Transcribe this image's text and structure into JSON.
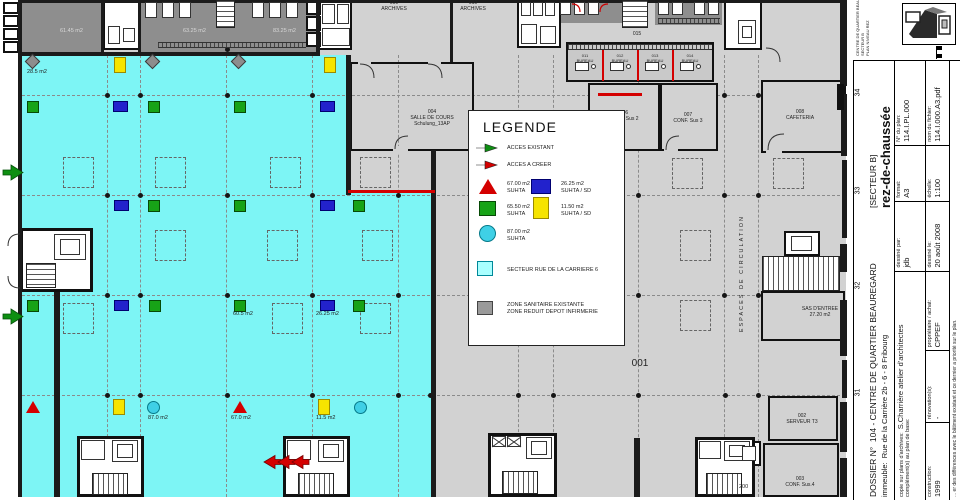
{
  "colors": {
    "sector_cyan": "#7df5f5",
    "floor_gray": "#d2d2d2",
    "dark_zone": "#8e8e8e",
    "green": "#17a317",
    "blue": "#2222cc",
    "yellow": "#f6e400",
    "red": "#d40000",
    "circle_cyan": "#3fd0e6",
    "legend_cyan": "#a9ffff",
    "wall": "#1b1b1b"
  },
  "legend": {
    "title": "LEGENDE",
    "items": [
      {
        "icon": "arrow-green",
        "lines": [
          "ACCES EXISTANT"
        ]
      },
      {
        "icon": "arrow-red",
        "lines": [
          "ACCES A CREER"
        ]
      },
      {
        "icon": "triangle-red",
        "lines": [
          "67.00 m2",
          "SUHTA"
        ]
      },
      {
        "icon": "square-blue",
        "lines": [
          "26.25 m2",
          "SUHTA / SD"
        ]
      },
      {
        "icon": "square-green",
        "lines": [
          "65.50 m2",
          "SUHTA"
        ]
      },
      {
        "icon": "square-yellow",
        "lines": [
          "11.50 m2",
          "SUHTA / SD"
        ]
      },
      {
        "icon": "circle-cyan",
        "lines": [
          "87.00 m2",
          "SUHTA"
        ]
      },
      {
        "icon": "square-cyan",
        "lines": [
          "SECTEUR RUE DE LA CARRIERE 6"
        ]
      },
      {
        "icon": "square-gray",
        "lines": [
          "ZONE SANITAIRE EXISTANTE",
          "ZONE REDUIT DEPOT INFIRMERIE"
        ]
      }
    ]
  },
  "plan": {
    "markers": [
      {
        "t": "diamond",
        "x": 27,
        "y": 56
      },
      {
        "t": "diamond",
        "x": 147,
        "y": 56
      },
      {
        "t": "diamond",
        "x": 233,
        "y": 56
      },
      {
        "t": "yellow",
        "x": 114,
        "y": 57
      },
      {
        "t": "yellow",
        "x": 324,
        "y": 57
      },
      {
        "t": "green",
        "x": 27,
        "y": 101
      },
      {
        "t": "blue",
        "x": 113,
        "y": 101
      },
      {
        "t": "green",
        "x": 148,
        "y": 101
      },
      {
        "t": "green",
        "x": 234,
        "y": 101
      },
      {
        "t": "blue",
        "x": 320,
        "y": 101
      },
      {
        "t": "blue",
        "x": 114,
        "y": 200
      },
      {
        "t": "green",
        "x": 148,
        "y": 200
      },
      {
        "t": "green",
        "x": 234,
        "y": 200
      },
      {
        "t": "blue",
        "x": 320,
        "y": 200
      },
      {
        "t": "green",
        "x": 353,
        "y": 200
      },
      {
        "t": "green",
        "x": 27,
        "y": 300
      },
      {
        "t": "blue",
        "x": 114,
        "y": 300
      },
      {
        "t": "green",
        "x": 149,
        "y": 300
      },
      {
        "t": "green",
        "x": 234,
        "y": 300
      },
      {
        "t": "blue",
        "x": 320,
        "y": 300
      },
      {
        "t": "green",
        "x": 353,
        "y": 300
      },
      {
        "t": "triangle",
        "x": 26,
        "y": 401
      },
      {
        "t": "yellow",
        "x": 113,
        "y": 399
      },
      {
        "t": "circle",
        "x": 147,
        "y": 401
      },
      {
        "t": "triangle",
        "x": 233,
        "y": 401
      },
      {
        "t": "yellow",
        "x": 318,
        "y": 399
      },
      {
        "t": "circle",
        "x": 354,
        "y": 401
      }
    ],
    "area_labels": [
      {
        "t": "28.5 m2",
        "x": 27,
        "y": 69
      },
      {
        "t": "60.5 m2",
        "x": 233,
        "y": 311
      },
      {
        "t": "26.25 m2",
        "x": 316,
        "y": 311
      },
      {
        "t": "87.0 m2",
        "x": 148,
        "y": 415
      },
      {
        "t": "67.0 m2",
        "x": 231,
        "y": 415
      },
      {
        "t": "11.5 m2",
        "x": 316,
        "y": 415
      },
      {
        "t": "61.45 m2",
        "x": 60,
        "y": 28,
        "dark": true
      },
      {
        "t": "63.25 m2",
        "x": 183,
        "y": 28,
        "dark": true
      },
      {
        "t": "83.25 m2",
        "x": 273,
        "y": 28,
        "dark": true
      },
      {
        "t": "200",
        "x": 739,
        "y": 484
      }
    ],
    "room_labels": [
      {
        "lines": [
          "009",
          "ARCHIVES"
        ],
        "x": 374,
        "y": 1,
        "w": 40,
        "fs": 5
      },
      {
        "lines": [
          "010",
          "ARCHIVES"
        ],
        "x": 453,
        "y": 1,
        "w": 40,
        "fs": 5
      },
      {
        "lines": [
          "004",
          "SALLE DE COURS",
          "Schulung_13AP"
        ],
        "x": 404,
        "y": 110,
        "w": 56,
        "fs": 5
      },
      {
        "lines": [
          "015"
        ],
        "x": 627,
        "y": 32,
        "w": 20,
        "fs": 5
      },
      {
        "lines": [
          "011",
          "BUREAU"
        ],
        "x": 569,
        "y": 54,
        "w": 32,
        "fs": 4
      },
      {
        "lines": [
          "012",
          "BUREAU"
        ],
        "x": 604,
        "y": 54,
        "w": 32,
        "fs": 4
      },
      {
        "lines": [
          "013",
          "BUREAU"
        ],
        "x": 639,
        "y": 54,
        "w": 32,
        "fs": 4
      },
      {
        "lines": [
          "014",
          "BUREAU"
        ],
        "x": 674,
        "y": 54,
        "w": 32,
        "fs": 4
      },
      {
        "lines": [
          "006",
          "CONF. Sus 2"
        ],
        "x": 602,
        "y": 111,
        "w": 44,
        "fs": 5
      },
      {
        "lines": [
          "007",
          "CONF. Sus 3"
        ],
        "x": 666,
        "y": 113,
        "w": 44,
        "fs": 5
      },
      {
        "lines": [
          "008",
          "CAFETERIA"
        ],
        "x": 778,
        "y": 110,
        "w": 44,
        "fs": 5
      },
      {
        "lines": [
          "001"
        ],
        "x": 626,
        "y": 358,
        "w": 28,
        "fs": 10
      },
      {
        "lines": [
          "SAS D'ENTREE",
          "27.20 m2"
        ],
        "x": 796,
        "y": 307,
        "w": 48,
        "fs": 5
      },
      {
        "lines": [
          "002",
          "SERVEUR T3"
        ],
        "x": 780,
        "y": 414,
        "w": 44,
        "fs": 5
      },
      {
        "lines": [
          "003",
          "CONF. Sus.4"
        ],
        "x": 778,
        "y": 477,
        "w": 44,
        "fs": 5
      },
      {
        "lines": [
          "ESPACES DE CIRCULATION"
        ],
        "x": 694,
        "y": 281,
        "w": 96,
        "fs": 5.5,
        "rot": true,
        "ls": 2
      }
    ],
    "grid_numbers": [
      {
        "n": "34",
        "y": 95
      },
      {
        "n": "33",
        "y": 193
      },
      {
        "n": "32",
        "y": 288
      },
      {
        "n": "31",
        "y": 395
      }
    ]
  },
  "title_block": {
    "dossier_label": "DOSSIER N°",
    "dossier": "104 - CENTRE DE QUARTIER BEAUREGARD",
    "secteur": "[SECTEUR B]",
    "floor": "rez-de-chaussée",
    "immeuble_label": "immeuble:",
    "immeuble": "Rue de la Carrière 2b - 6 - 8  Fribourg",
    "copie_label": "copie sur plans d'archives:",
    "copie": "S.Charrière atelier d'architectes",
    "complement_label": "complément(s) au plan de base:",
    "construction_label": "construction:",
    "construction": "1999",
    "renovation_label": "rénovation(s):",
    "renovation": "-",
    "proprietaire_label": "propriétaire / achat:",
    "proprietaire": "CPPEF",
    "dessine_par_label": "dessiné par:",
    "dessine_par": "jdb",
    "dessine_le_label": "dessiné le:",
    "dessine_le": "20 août 2008",
    "format_label": "format:",
    "format": "A3",
    "echelle_label": "échelle:",
    "echelle": "1:100",
    "plan_no_label": "N° du plan:",
    "plan_no": "114.I.PL.000",
    "fichier_label": "nom du fichier:",
    "fichier": "114.I.000.A3.pdf",
    "footnote": "... er des différences avec le bâtiment existant et ce dernier a priorité sur le plan.",
    "project_lines": [
      "CENTRE DE QUARTIER BEAUREGARD - FRIBOURG",
      "SECTEUR B",
      "PLAN NIVEAU REZ"
    ]
  }
}
